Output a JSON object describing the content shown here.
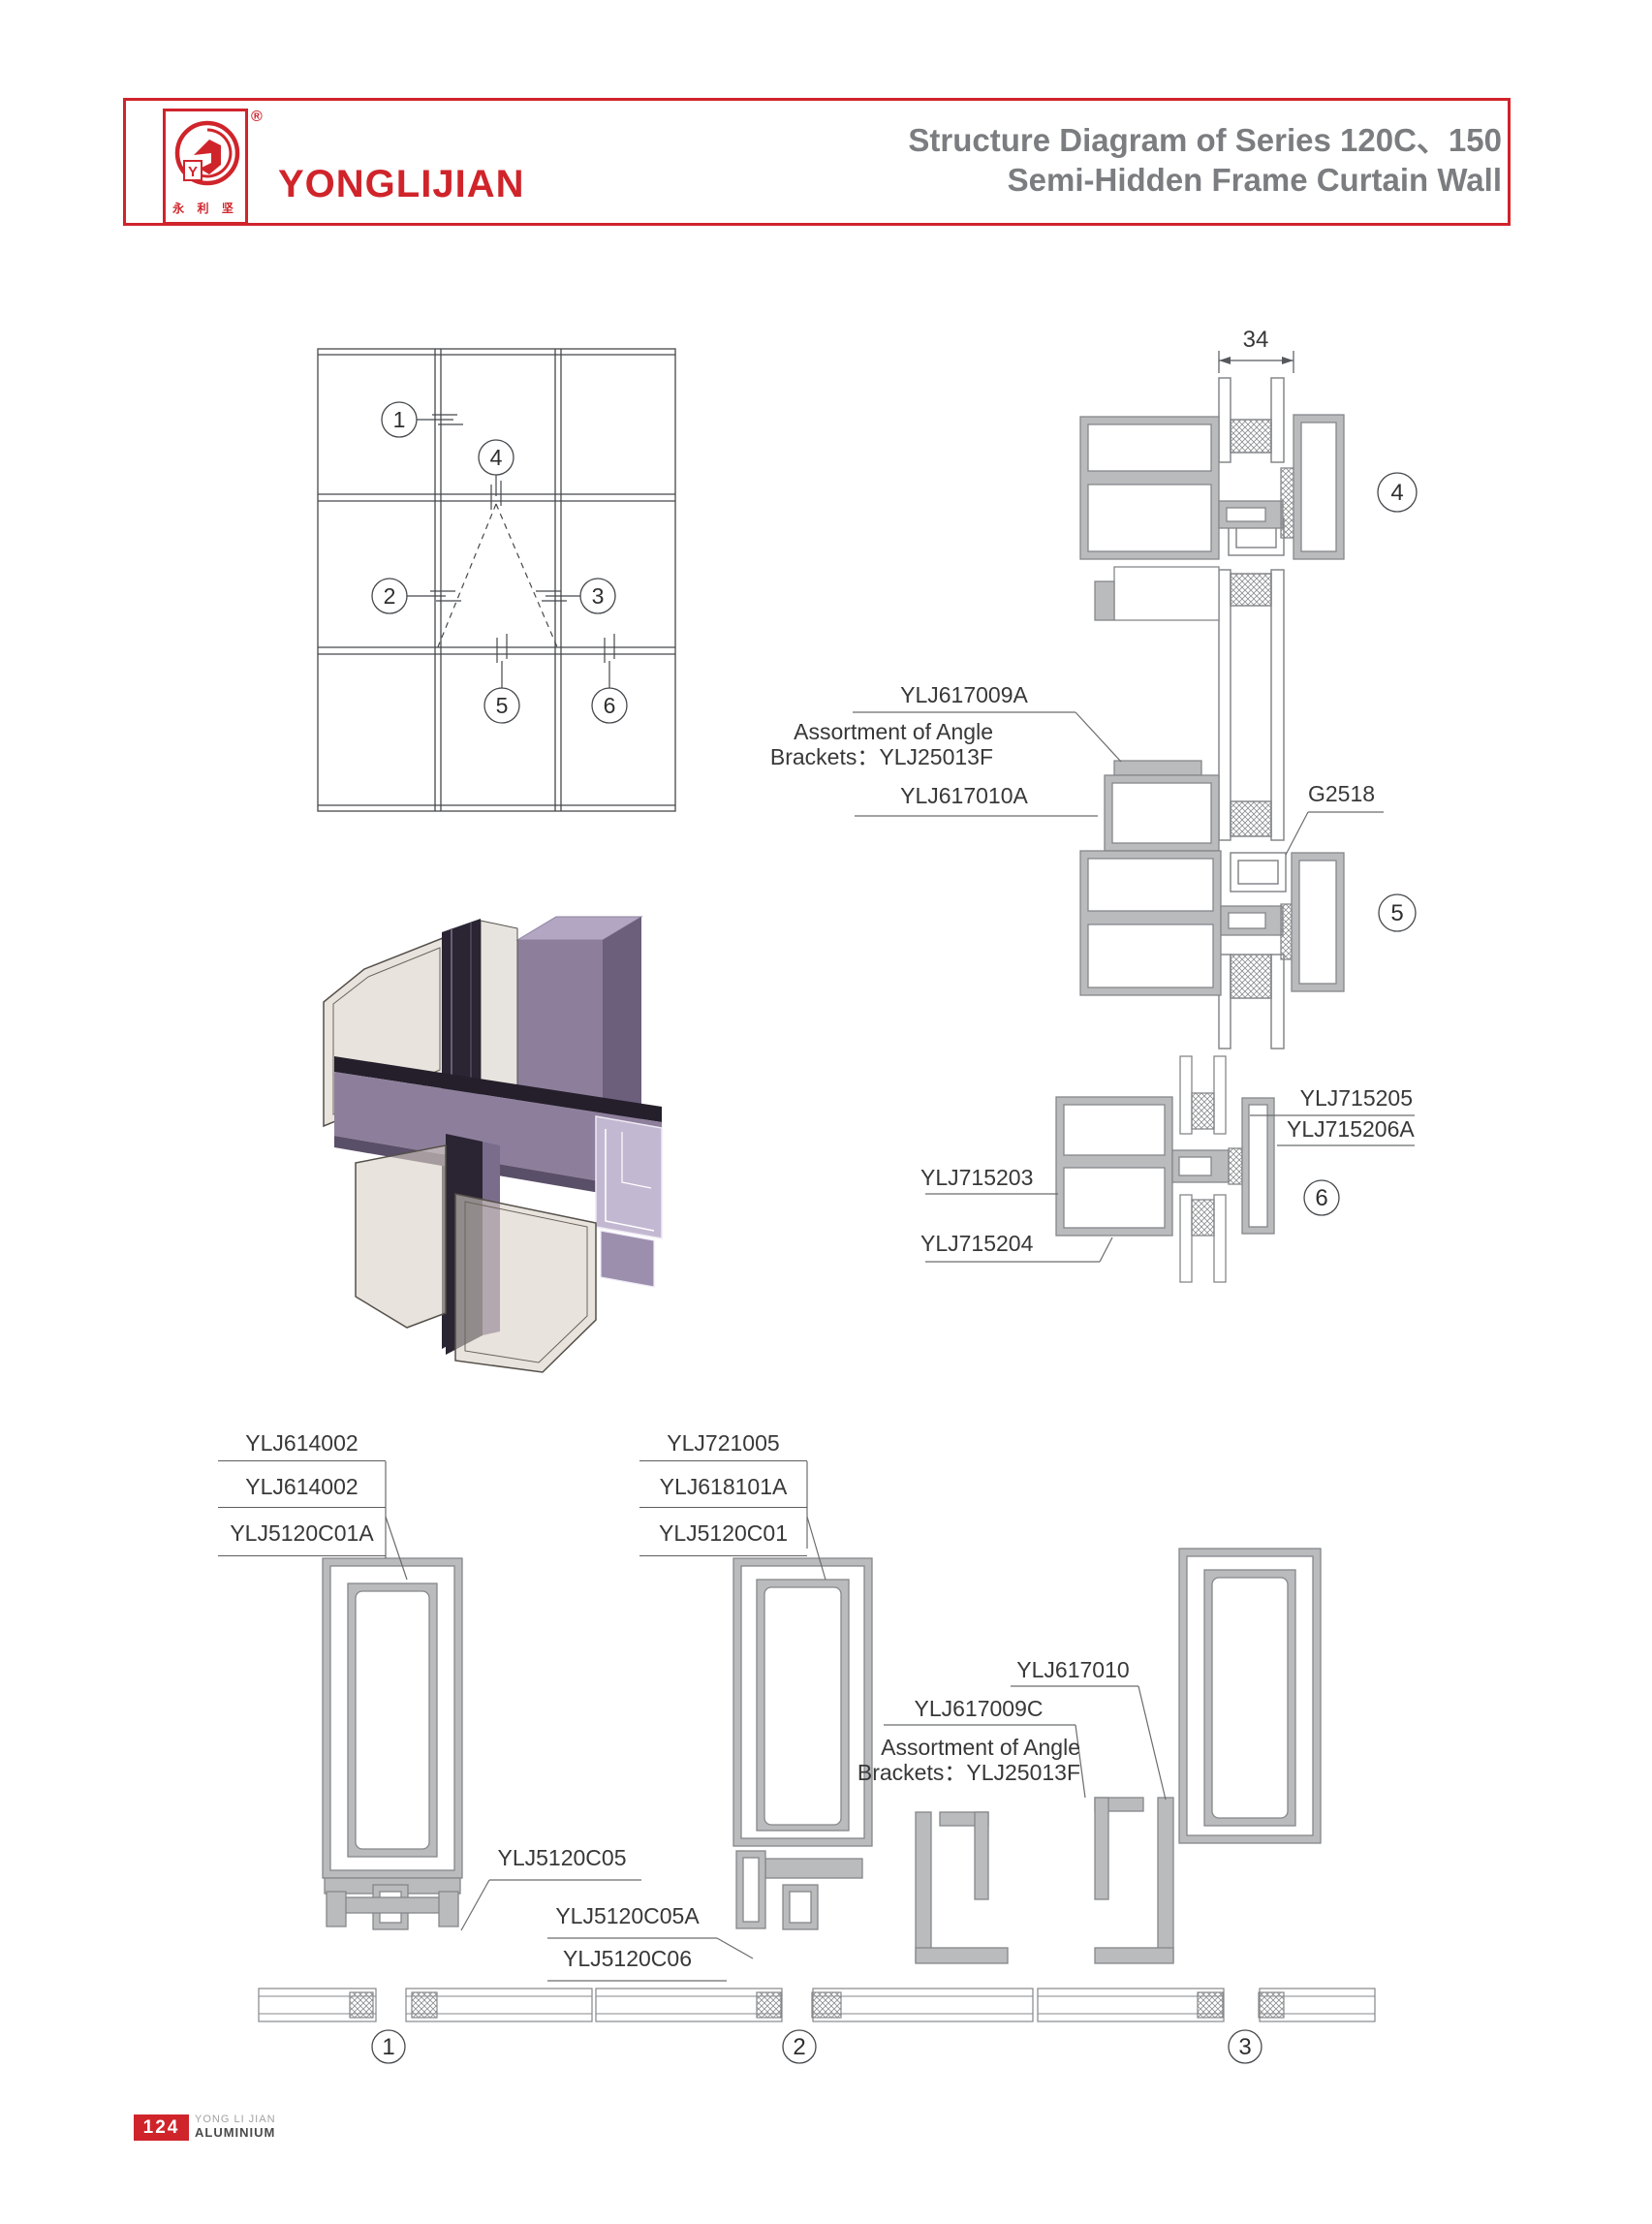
{
  "header": {
    "brand": "YONGLIJIAN",
    "brand_cn": "永 利 坚",
    "registered_mark": "®",
    "logo_letter": "Y",
    "title_line1": "Structure Diagram of Series 120C、150",
    "title_line2": "Semi-Hidden Frame Curtain Wall"
  },
  "elevation": {
    "callouts": [
      "1",
      "2",
      "3",
      "4",
      "5",
      "6"
    ]
  },
  "right_details": {
    "dim_label": "34",
    "label_617009a": "YLJ617009A",
    "angle_note_line1": "Assortment of Angle",
    "angle_note_line2": "Brackets：YLJ25013F",
    "label_617010a": "YLJ617010A",
    "label_g2518": "G2518",
    "label_715205": "YLJ715205",
    "label_715206a": "YLJ715206A",
    "label_715203": "YLJ715203",
    "label_715204": "YLJ715204",
    "callout_4": "4",
    "callout_5": "5",
    "callout_6": "6"
  },
  "bottom_details": {
    "left_stack": [
      "YLJ614002",
      "YLJ614002",
      "YLJ5120C01A"
    ],
    "mid_stack": [
      "YLJ721005",
      "YLJ618101A",
      "YLJ5120C01"
    ],
    "label_617010": "YLJ617010",
    "label_617009c": "YLJ617009C",
    "angle_note_line1": "Assortment of Angle",
    "angle_note_line2": "Brackets：YLJ25013F",
    "label_5120c05": "YLJ5120C05",
    "label_5120c05a": "YLJ5120C05A",
    "label_5120c06": "YLJ5120C06",
    "callout_1": "1",
    "callout_2": "2",
    "callout_3": "3"
  },
  "footer": {
    "page_number": "124",
    "brand_line1": "YONG LI JIAN",
    "brand_line2": "ALUMINIUM"
  },
  "colors": {
    "accent": "#d0242b",
    "title_gray": "#7b7d80",
    "cad_stroke": "#85878a",
    "cad_fill": "#b9bbbd"
  }
}
